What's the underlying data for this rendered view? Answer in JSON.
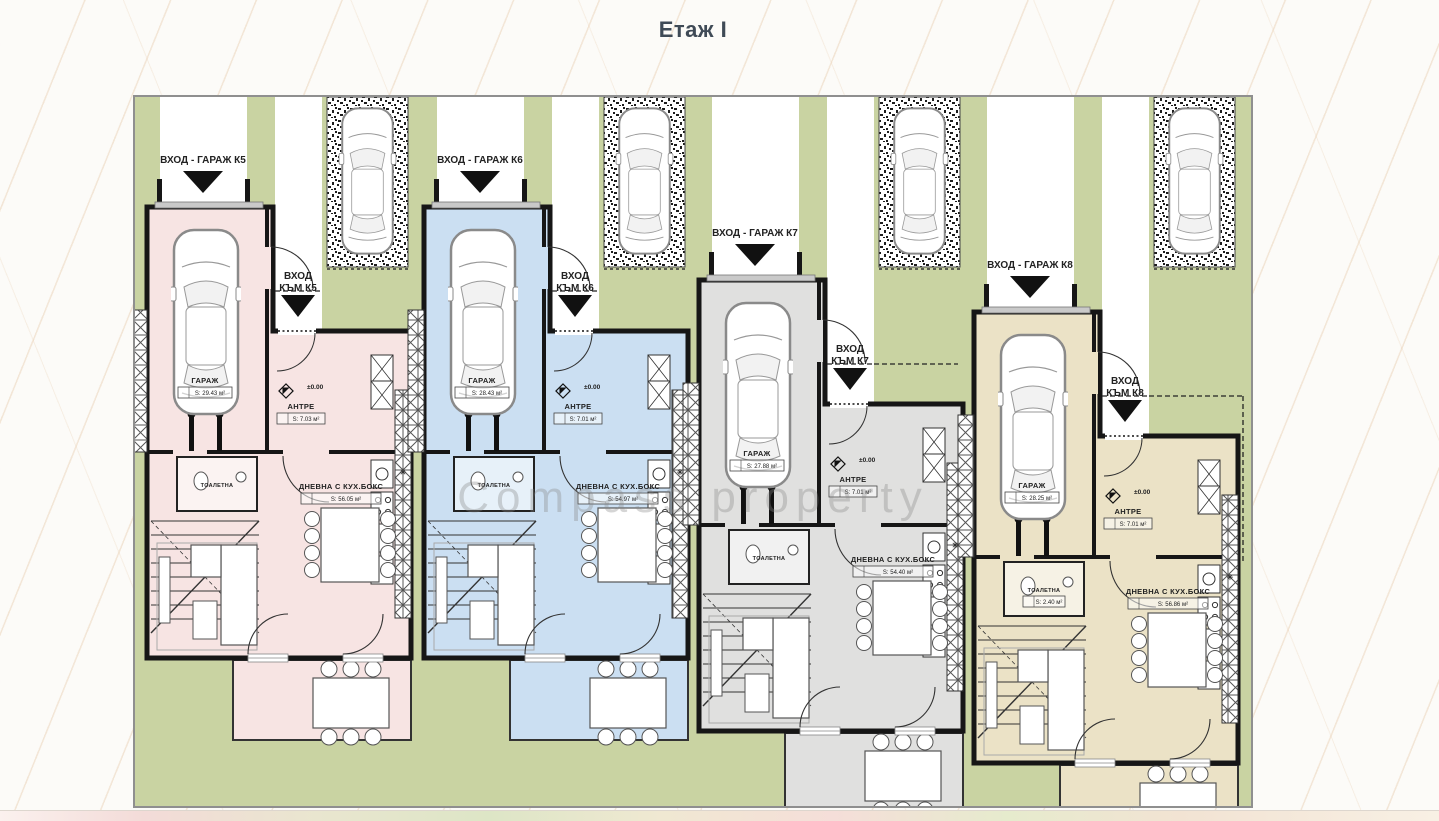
{
  "page": {
    "title": "Етаж I",
    "watermark": "Compass property",
    "background": "#fcfbf8",
    "diagonal_line_color": "#e7cbac",
    "title_color": "#3f4a56"
  },
  "plan": {
    "green": "#c9d3a2",
    "wall": "#161616",
    "driveway": "#ffffff",
    "border": "#8f8f8f",
    "snowflake_symbol": "✳",
    "units": [
      {
        "id": "K5",
        "color": "#f7e4e3",
        "x": 145,
        "y": 205,
        "labels": {
          "garage_entrance": "ВХОД - ГАРАЖ К5",
          "entrance_line1": "ВХОД",
          "entrance_line2": "КЪМ К5",
          "elevation": "±0.00",
          "garage_name": "ГАРАЖ",
          "garage_area": "S: 29.43 м²",
          "antre_name": "АНТРЕ",
          "antre_area": "S: 7.03 м²",
          "toilet_name": "ТОАЛЕТНА",
          "toilet_area": "",
          "living_name": "ДНЕВНА С КУХ.БОКС",
          "living_area": "S: 56.05 м²"
        }
      },
      {
        "id": "K6",
        "color": "#cbdff2",
        "x": 422,
        "y": 205,
        "labels": {
          "garage_entrance": "ВХОД - ГАРАЖ К6",
          "entrance_line1": "ВХОД",
          "entrance_line2": "КЪМ К6",
          "elevation": "±0.00",
          "garage_name": "ГАРАЖ",
          "garage_area": "S: 28.43 м²",
          "antre_name": "АНТРЕ",
          "antre_area": "S: 7.01 м²",
          "toilet_name": "ТОАЛЕТНА",
          "toilet_area": "",
          "living_name": "ДНЕВНА С КУХ.БОКС",
          "living_area": "S: 54.97 м²"
        }
      },
      {
        "id": "K7",
        "color": "#e0e0df",
        "x": 697,
        "y": 278,
        "labels": {
          "garage_entrance": "ВХОД - ГАРАЖ К7",
          "entrance_line1": "ВХОД",
          "entrance_line2": "КЪМ К7",
          "elevation": "±0.00",
          "garage_name": "ГАРАЖ",
          "garage_area": "S: 27.88 м²",
          "antre_name": "АНТРЕ",
          "antre_area": "S: 7.01 м²",
          "toilet_name": "ТОАЛЕТНА",
          "toilet_area": "",
          "living_name": "ДНЕВНА С КУХ.БОКС",
          "living_area": "S: 54.40 м²"
        }
      },
      {
        "id": "K8",
        "color": "#ebe2c6",
        "x": 972,
        "y": 310,
        "labels": {
          "garage_entrance": "ВХОД - ГАРАЖ К8",
          "entrance_line1": "ВХОД",
          "entrance_line2": "КЪМ К8",
          "elevation": "±0.00",
          "garage_name": "ГАРАЖ",
          "garage_area": "S: 28.25 м²",
          "antre_name": "АНТРЕ",
          "antre_area": "S: 7.01 м²",
          "toilet_name": "ТОАЛЕТНА",
          "toilet_area": "S: 2.40 м²",
          "living_name": "ДНЕВНА С КУХ.БОКС",
          "living_area": "S: 56.86 м²"
        }
      }
    ]
  }
}
